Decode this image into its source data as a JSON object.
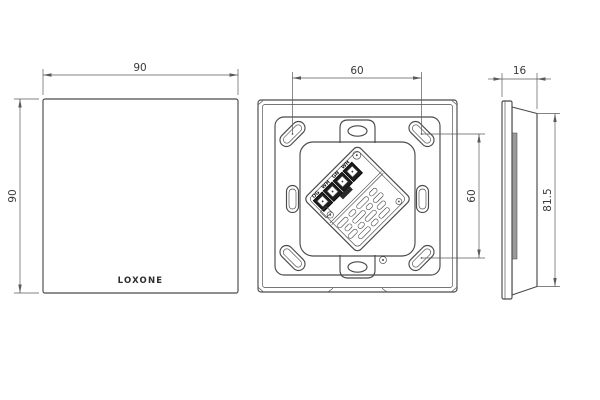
{
  "brand": {
    "logo_text": "LOXONE"
  },
  "views": {
    "front": {
      "dim_width": "90",
      "dim_height": "90"
    },
    "rear": {
      "dim_hole_spacing_h": "60",
      "dim_hole_spacing_v": "60",
      "terminal_labels": [
        "OG",
        "WH",
        "GN",
        "WH"
      ]
    },
    "side": {
      "dim_depth": "16",
      "dim_height": "81.5"
    }
  },
  "colors": {
    "line": "#4a4a4a",
    "dimension": "#5a5a5a",
    "text": "#3a3a3a",
    "terminal_fill": "#1d1d1d",
    "shading": "#9a9a9a",
    "background": "#ffffff"
  }
}
